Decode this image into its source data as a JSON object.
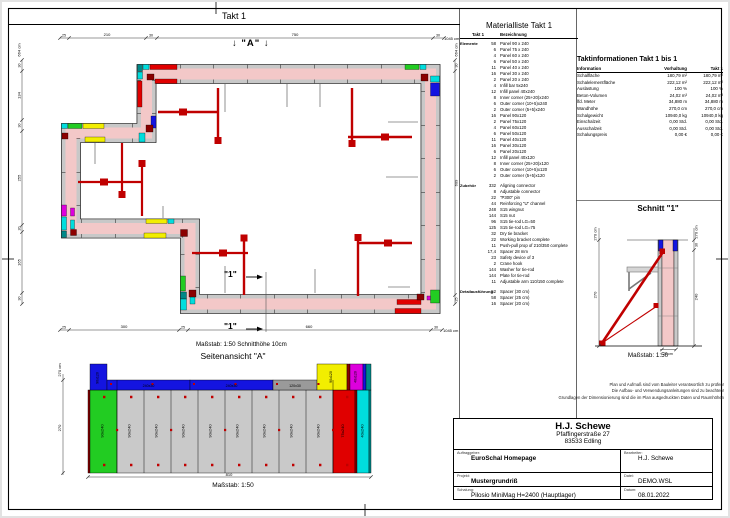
{
  "colors": {
    "wall_concrete": "#f3c8c8",
    "panel_gray": "#c8c8c8",
    "prop_red": "#c00000",
    "panel_red": "#e00000",
    "panel_yellow": "#f2ee00",
    "panel_green": "#22cc22",
    "panel_cyan": "#00dddd",
    "panel_blue": "#1414e0",
    "panel_magenta": "#dd00dd",
    "panel_darkred": "#8b0000",
    "panel_teal": "#008888"
  },
  "band": {
    "title": "Takt 1"
  },
  "plan": {
    "scale_note": "Maßstab: 1:50   Schnitthöhe 10cm",
    "marker_a": "↓ \"A\" ↓",
    "marker_1": "\"1\"",
    "dims": {
      "top": {
        "segs": [
          "25",
          "210",
          "30",
          "750",
          "30"
        ],
        "total": "1045 cm"
      },
      "bottom": {
        "segs": [
          "25",
          "300",
          "25",
          "660",
          "30"
        ],
        "total": "1045 cm"
      },
      "left": {
        "segs": [
          "30",
          "134",
          "30",
          "255",
          "20",
          "165",
          "30"
        ],
        "total": "664 cm"
      },
      "right": {
        "segs": [
          "30",
          "609",
          "25"
        ],
        "total": "664 cm"
      }
    }
  },
  "materials": {
    "title": "Materialliste  Takt 1",
    "col_qty": "Takt 1",
    "col_name": "Bezeichnung",
    "groups": [
      {
        "label": "Elemente",
        "rows": [
          {
            "q": "58",
            "n": "Panel 90 x 240"
          },
          {
            "q": "6",
            "n": "Panel 75 x 240"
          },
          {
            "q": "4",
            "n": "Panel 60 x 240"
          },
          {
            "q": "6",
            "n": "Panel 50 x 240"
          },
          {
            "q": "11",
            "n": "Panel 40 x 240"
          },
          {
            "q": "16",
            "n": "Panel 30 x 240"
          },
          {
            "q": "2",
            "n": "Panel 20 x 240"
          },
          {
            "q": "4",
            "n": "Infill bar 5x240"
          },
          {
            "q": "12",
            "n": "Infill panel 40x240"
          },
          {
            "q": "8",
            "n": "Inner corner (25+20)x240"
          },
          {
            "q": "6",
            "n": "Outer corner (10+5)x240"
          },
          {
            "q": "2",
            "n": "Outer corner (5+5)x240"
          },
          {
            "q": "16",
            "n": "Panel 90x120"
          },
          {
            "q": "2",
            "n": "Panel 75x120"
          },
          {
            "q": "4",
            "n": "Panel 60x120"
          },
          {
            "q": "6",
            "n": "Panel 50x120"
          },
          {
            "q": "11",
            "n": "Panel 40x120"
          },
          {
            "q": "16",
            "n": "Panel 30x120"
          },
          {
            "q": "6",
            "n": "Panel 20x120"
          },
          {
            "q": "12",
            "n": "Infill panel 40x120"
          },
          {
            "q": "8",
            "n": "Inner corner (25+20)x120"
          },
          {
            "q": "6",
            "n": "Outer corner (10+5)x120"
          },
          {
            "q": "2",
            "n": "Outer corner (5+5)x120"
          }
        ]
      },
      {
        "label": "Zubehör",
        "rows": [
          {
            "q": "332",
            "n": "Aligning connector"
          },
          {
            "q": "8",
            "n": "Adjustable connector"
          },
          {
            "q": "22",
            "n": "\"P300\" pin"
          },
          {
            "q": "44",
            "n": "Reinforcing \"U\" channel"
          },
          {
            "q": "248",
            "n": "S15 wingnut"
          },
          {
            "q": "144",
            "n": "S15 nut"
          },
          {
            "q": "96",
            "n": "S15 tie-rod LG=50"
          },
          {
            "q": "125",
            "n": "S15 tie-rod LG=75"
          },
          {
            "q": "32",
            "n": "Dry tie bracket"
          },
          {
            "q": "22",
            "n": "Working bracket complete"
          },
          {
            "q": "11",
            "n": "Push-pull prop of 210/350 complete"
          },
          {
            "q": "17,4",
            "n": "Spacer 28 mm"
          },
          {
            "q": "23",
            "n": "Safety device of 3"
          },
          {
            "q": "2",
            "n": "Crane hook"
          },
          {
            "q": "144",
            "n": "Washer for tie-rod"
          },
          {
            "q": "144",
            "n": "Plate for tie-rod"
          },
          {
            "q": "11",
            "n": "Adjustable arm 110/150 complete"
          }
        ]
      },
      {
        "label": "Detailausführung",
        "rows": [
          {
            "q": "52",
            "n": "Spacer (30 cm)"
          },
          {
            "q": "58",
            "n": "Spacer (25 cm)"
          },
          {
            "q": "16",
            "n": "Spacer (20 cm)"
          }
        ]
      }
    ]
  },
  "takt_info": {
    "title": "Taktinformationen  Takt 1 bis 1",
    "headers": {
      "info": "Information",
      "stock": "Vorhaltung",
      "takt": "Takt 1"
    },
    "rows": [
      {
        "k": "Schalfläche",
        "v1": "180,79 m²",
        "v2": "180,79 m²"
      },
      {
        "k": "Schalelementfläche",
        "v1": "222,12 m²",
        "v2": "222,12 m²"
      },
      {
        "k": "Auslastung",
        "v1": "100 %",
        "v2": "100 %"
      },
      {
        "k": "Beton-Volumen",
        "v1": "24,02 m³",
        "v2": "24,02 m³"
      },
      {
        "k": "lfd. Meter",
        "v1": "34,880 m",
        "v2": "34,880 m"
      },
      {
        "k": "Wandhöhe",
        "v1": "270,0 cm",
        "v2": "270,0 cm"
      },
      {
        "k": "Schalgewicht",
        "v1": "10940,0 kg",
        "v2": "10940,0 kg"
      },
      {
        "k": "Einschalzeit",
        "v1": "0,00 Std.",
        "v2": "0,00 Std."
      },
      {
        "k": "Ausschalzeit",
        "v1": "0,00 Std.",
        "v2": "0,00 Std."
      },
      {
        "k": "Schalungspreis",
        "v1": "0,00 €",
        "v2": "0,00 €"
      }
    ]
  },
  "schnitt": {
    "title": "Schnitt \"1\"",
    "scale": "Maßstab: 1:50",
    "dim_left_total": "270 cm",
    "dim_left": "270",
    "dim_right_total": "270 cm",
    "dim_right_top": "30",
    "dim_right_main": "240",
    "dim_bottom": "25 cm"
  },
  "side_view": {
    "title": "Seitenansicht \"A\"",
    "scale": "Maßstab: 1:50",
    "dim_left_total": "270 cm",
    "dim_left": "270",
    "dim_bottom": "810",
    "main_panels": [
      "90x240",
      "90x240",
      "90x240",
      "90x240",
      "90x240",
      "90x240",
      "90x240",
      "90x240",
      "90x240",
      "75x240",
      "40x240"
    ],
    "top_panels": [
      "90x120",
      "240x30",
      "240x30",
      "120x30",
      "90x120",
      "40x120"
    ]
  },
  "notes": {
    "lines": [
      "Plan und Aufmaß sind vom Bauleiter verantwortlich zu prüfen!",
      "Die Aufbau- und Verwendungsanleitungen sind zu beachten!",
      "Grundlagen der Dimensionierung sind die im Plan ausgedruckten Daten und Raumhöhen"
    ]
  },
  "title_block": {
    "company": "H.J. Schewe",
    "address1": "Pfaffingerstraße 27",
    "address2": "83533 Edling",
    "labels": {
      "client": "Auftraggeber:",
      "editor": "Bearbeiter:",
      "project": "Projekt:",
      "file": "Datei:",
      "formwork": "Schalung:",
      "date": "Datum:"
    },
    "values": {
      "client": "EuroSchal Homepage",
      "editor": "H.J. Schewe",
      "project": "Mustergrundriß",
      "file": "DEMO.WSL",
      "formwork": "Pilosio MiniMag H=2400 (Hauptlager)",
      "date": "08.01.2022"
    }
  }
}
